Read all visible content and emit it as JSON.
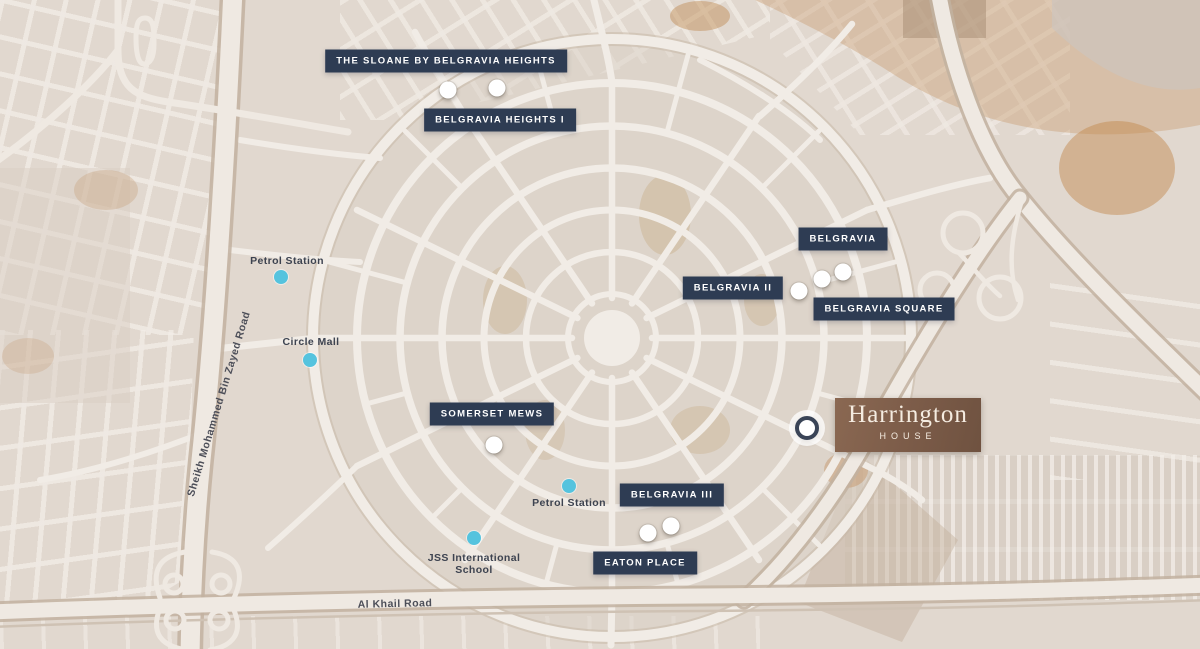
{
  "labels": {
    "sloane": "THE SLOANE BY BELGRAVIA HEIGHTS",
    "belgravia_heights_i": "BELGRAVIA HEIGHTS I",
    "belgravia": "BELGRAVIA",
    "belgravia_ii": "BELGRAVIA II",
    "belgravia_square": "BELGRAVIA SQUARE",
    "somerset_mews": "SOMERSET MEWS",
    "belgravia_iii": "BELGRAVIA III",
    "eaton_place": "EATON PLACE"
  },
  "harrington": {
    "name": "Harrington",
    "subtitle": "HOUSE"
  },
  "pois": {
    "petrol_station_north": "Petrol Station",
    "circle_mall": "Circle Mall",
    "petrol_station_south": "Petrol Station",
    "jss_school_line1": "JSS International",
    "jss_school_line2": "School"
  },
  "roads": {
    "sheikh_mohammed_bin_zayed": "Sheikh Mohammed Bin Zayed Road",
    "al_khail": "Al Khail Road"
  },
  "colors": {
    "label_navy": "#2e3c53",
    "harrington_brown": "#7b5b48",
    "poi_dot_cyan": "#55c3de",
    "project_dot_white": "#ffffff",
    "map_background": "#e1d8cf",
    "road_fill": "#f1ece6"
  }
}
